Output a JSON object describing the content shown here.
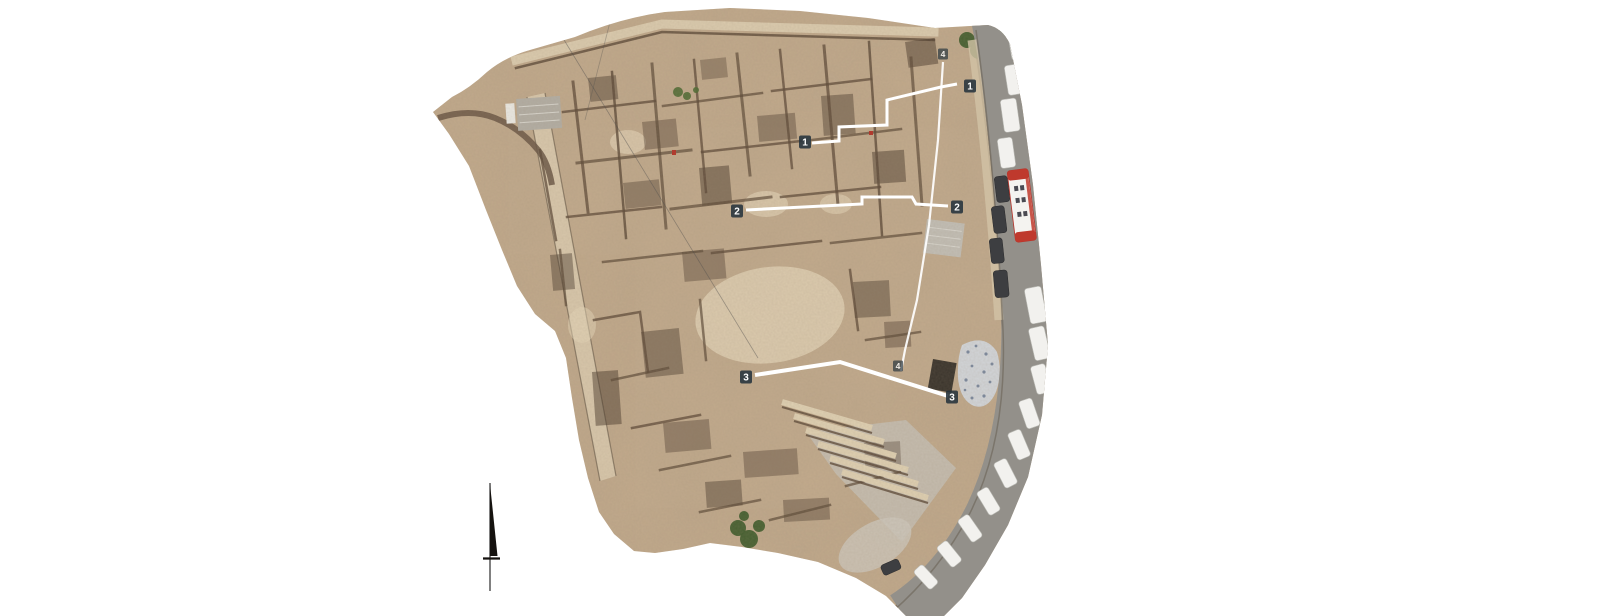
{
  "annotations": {
    "sections": [
      {
        "id": "section-1",
        "left_label": "1",
        "right_label": "1"
      },
      {
        "id": "section-2",
        "left_label": "2",
        "right_label": "2"
      },
      {
        "id": "section-3",
        "left_label": "3",
        "right_label": "3"
      },
      {
        "id": "section-4",
        "top_label": "4",
        "bottom_label": "4"
      }
    ],
    "north_arrow_icon": "north-arrow"
  },
  "palette": {
    "background": "#ffffff",
    "ground": "#c3ab8d",
    "ground_light": "#dccbaf",
    "wall": "#5d4a38",
    "road": "#93908a",
    "bus_red": "#bf392d",
    "vehicle_white": "#f2f1ee",
    "vehicle_dark": "#3d3e41",
    "tree_green": "#415d2d",
    "tarp_blue_white": "#d3d7dd",
    "marker_red": "#b33227",
    "section_line": "#ffffff",
    "label_bg": "#26333c",
    "label_text": "#ffffff"
  }
}
